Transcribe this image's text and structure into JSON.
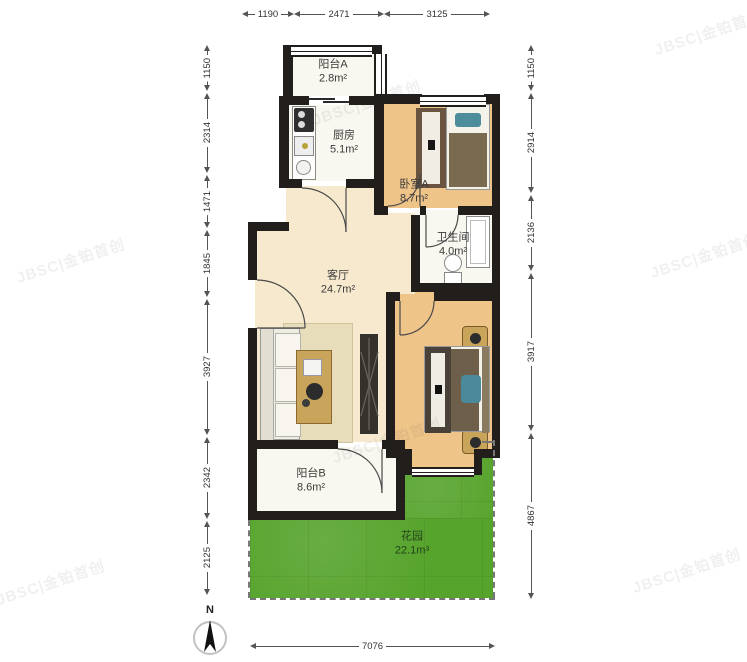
{
  "watermark": {
    "text": "JBSC|金铂首创"
  },
  "compass": {
    "label": "N"
  },
  "rooms": {
    "balcony_a": {
      "name": "阳台A",
      "area": "2.8m²"
    },
    "kitchen": {
      "name": "厨房",
      "area": "5.1m²"
    },
    "bedroom_a": {
      "name": "卧室A",
      "area": "8.7m²"
    },
    "bathroom": {
      "name": "卫生间",
      "area": "4.0m²"
    },
    "living_room": {
      "name": "客厅",
      "area": "24.7m²"
    },
    "balcony_b": {
      "name": "阳台B",
      "area": "8.6m²"
    },
    "garden": {
      "name": "花园",
      "area": "22.1m³"
    }
  },
  "dimensions": {
    "top": [
      "1190",
      "2471",
      "3125"
    ],
    "left": [
      "1150",
      "2314",
      "1471",
      "1845",
      "3927",
      "2342",
      "2125"
    ],
    "right": [
      "1150",
      "2914",
      "2136",
      "3917",
      "4867"
    ],
    "bottom": [
      "7076"
    ]
  },
  "colors": {
    "wall": "#211e1b",
    "wood_floor": "#efc489",
    "living_floor": "#f6e9cd",
    "balcony_floor": "#f8f7f0",
    "garden_green": "#57a42d",
    "accent_teal": "#4e8e9c"
  }
}
